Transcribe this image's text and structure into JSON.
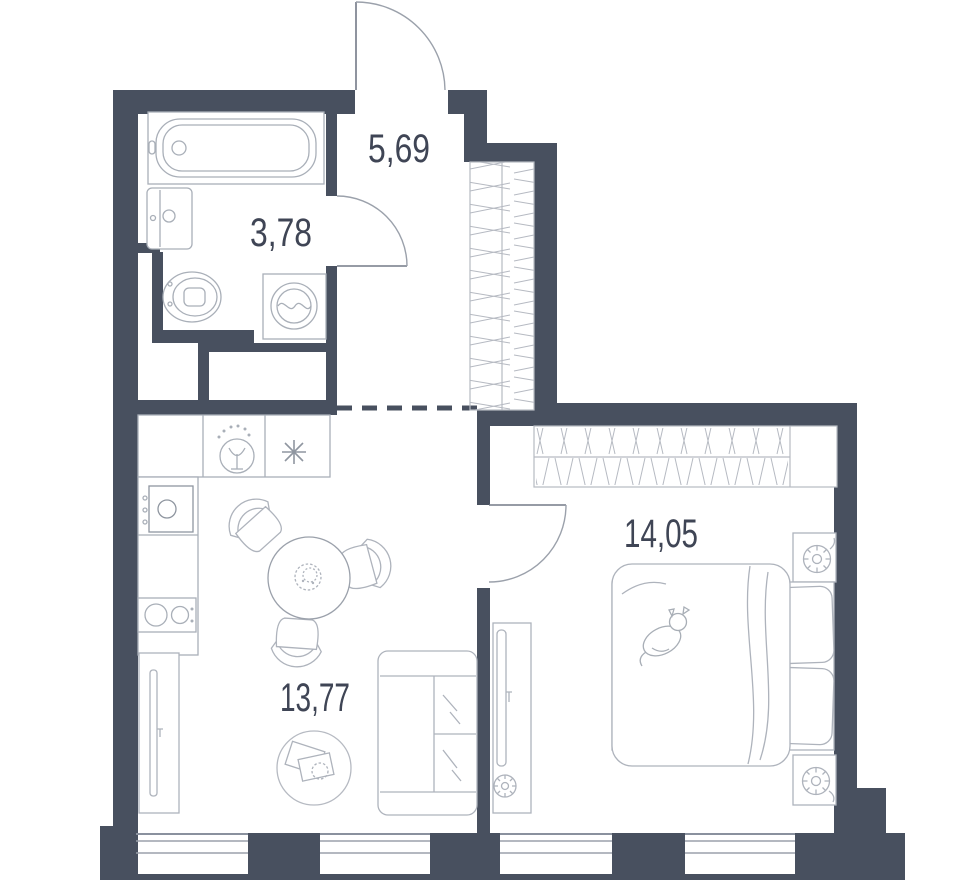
{
  "plan": {
    "title": "apartment-floor-plan",
    "rooms": [
      {
        "name": "hallway",
        "area": "5,69"
      },
      {
        "name": "bathroom",
        "area": "3,78"
      },
      {
        "name": "bedroom",
        "area": "14,05"
      },
      {
        "name": "living-kitchen",
        "area": "13,77"
      }
    ],
    "colors": {
      "wall": "#48505f",
      "furniture_light": "#b6bac2",
      "furniture_medium": "#9ba1ab",
      "door_leaf": "#737a87",
      "text": "#3f4555",
      "background": "#ffffff"
    },
    "fixtures": [
      "entrance-door",
      "bathroom-door",
      "bedroom-door",
      "bathtub",
      "bathroom-sink",
      "toilet",
      "washing-machine",
      "hallway-wardrobe",
      "bedroom-wardrobe",
      "kitchen-counter",
      "kitchen-faucet-symbol",
      "hob-symbol",
      "kitchen-sink",
      "cooktop",
      "dining-table",
      "dining-chairs",
      "table-plant",
      "sofa",
      "rug",
      "tv-stand-living",
      "tv-panel-bedroom",
      "bed",
      "duvet",
      "pillows",
      "cat",
      "nightstands",
      "windows"
    ]
  }
}
